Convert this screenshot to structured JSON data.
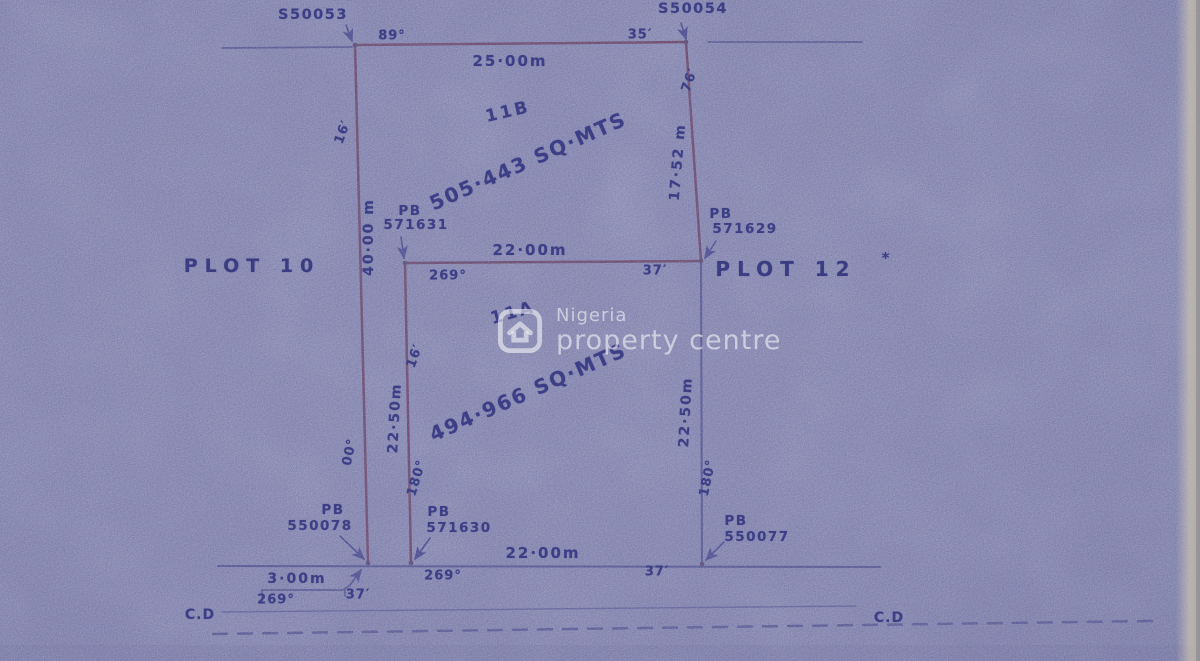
{
  "watermark": {
    "name": "Nigeria",
    "tagline": "property centre"
  },
  "plot_labels": {
    "left": "PLOT 10",
    "right": "PLOT 12",
    "mark": "*"
  },
  "parcels": {
    "b": {
      "id": "11B",
      "area": "505·443 SQ·MTS"
    },
    "a": {
      "id": "11A",
      "area": "494·966 SQ·MTS"
    }
  },
  "beacons": {
    "tl": {
      "pb": "PB",
      "num": "S50053"
    },
    "tr": {
      "num": "S50054"
    },
    "ml": {
      "pb": "PB",
      "num": "571631"
    },
    "mr": {
      "pb": "PB",
      "num": "571629"
    },
    "bl": {
      "pb": "PB",
      "num": "550078"
    },
    "bm": {
      "pb": "PB",
      "num": "571630"
    },
    "br": {
      "pb": "PB",
      "num": "550077"
    }
  },
  "dims": {
    "top": "25·00m",
    "mid": "22·00m",
    "bottom": "22·00m",
    "left": "40·00 m",
    "right_upper": "17·52 m",
    "inner": "22·50m",
    "right_lower": "22·50m",
    "notch": "3·00m"
  },
  "bearings": {
    "top_left": "89°",
    "top_right": "35′",
    "left_upper": "16′",
    "right_upper": "76′",
    "mid_left": "269°",
    "mid_right": "37′",
    "inner_upper": "16′",
    "left_lower": "00°",
    "inner_lower": "180°",
    "right_lower": "180°",
    "bottom_left": "269°",
    "bottom_right": "37′",
    "notch_left": "269°",
    "notch_right": "37′"
  },
  "datum": {
    "left": "C.D",
    "right": "C.D"
  },
  "colors": {
    "paper": "#adb0c5",
    "ink": "#3c3f86",
    "parcel_line": "#7c3a43",
    "survey_line": "#474a82"
  }
}
